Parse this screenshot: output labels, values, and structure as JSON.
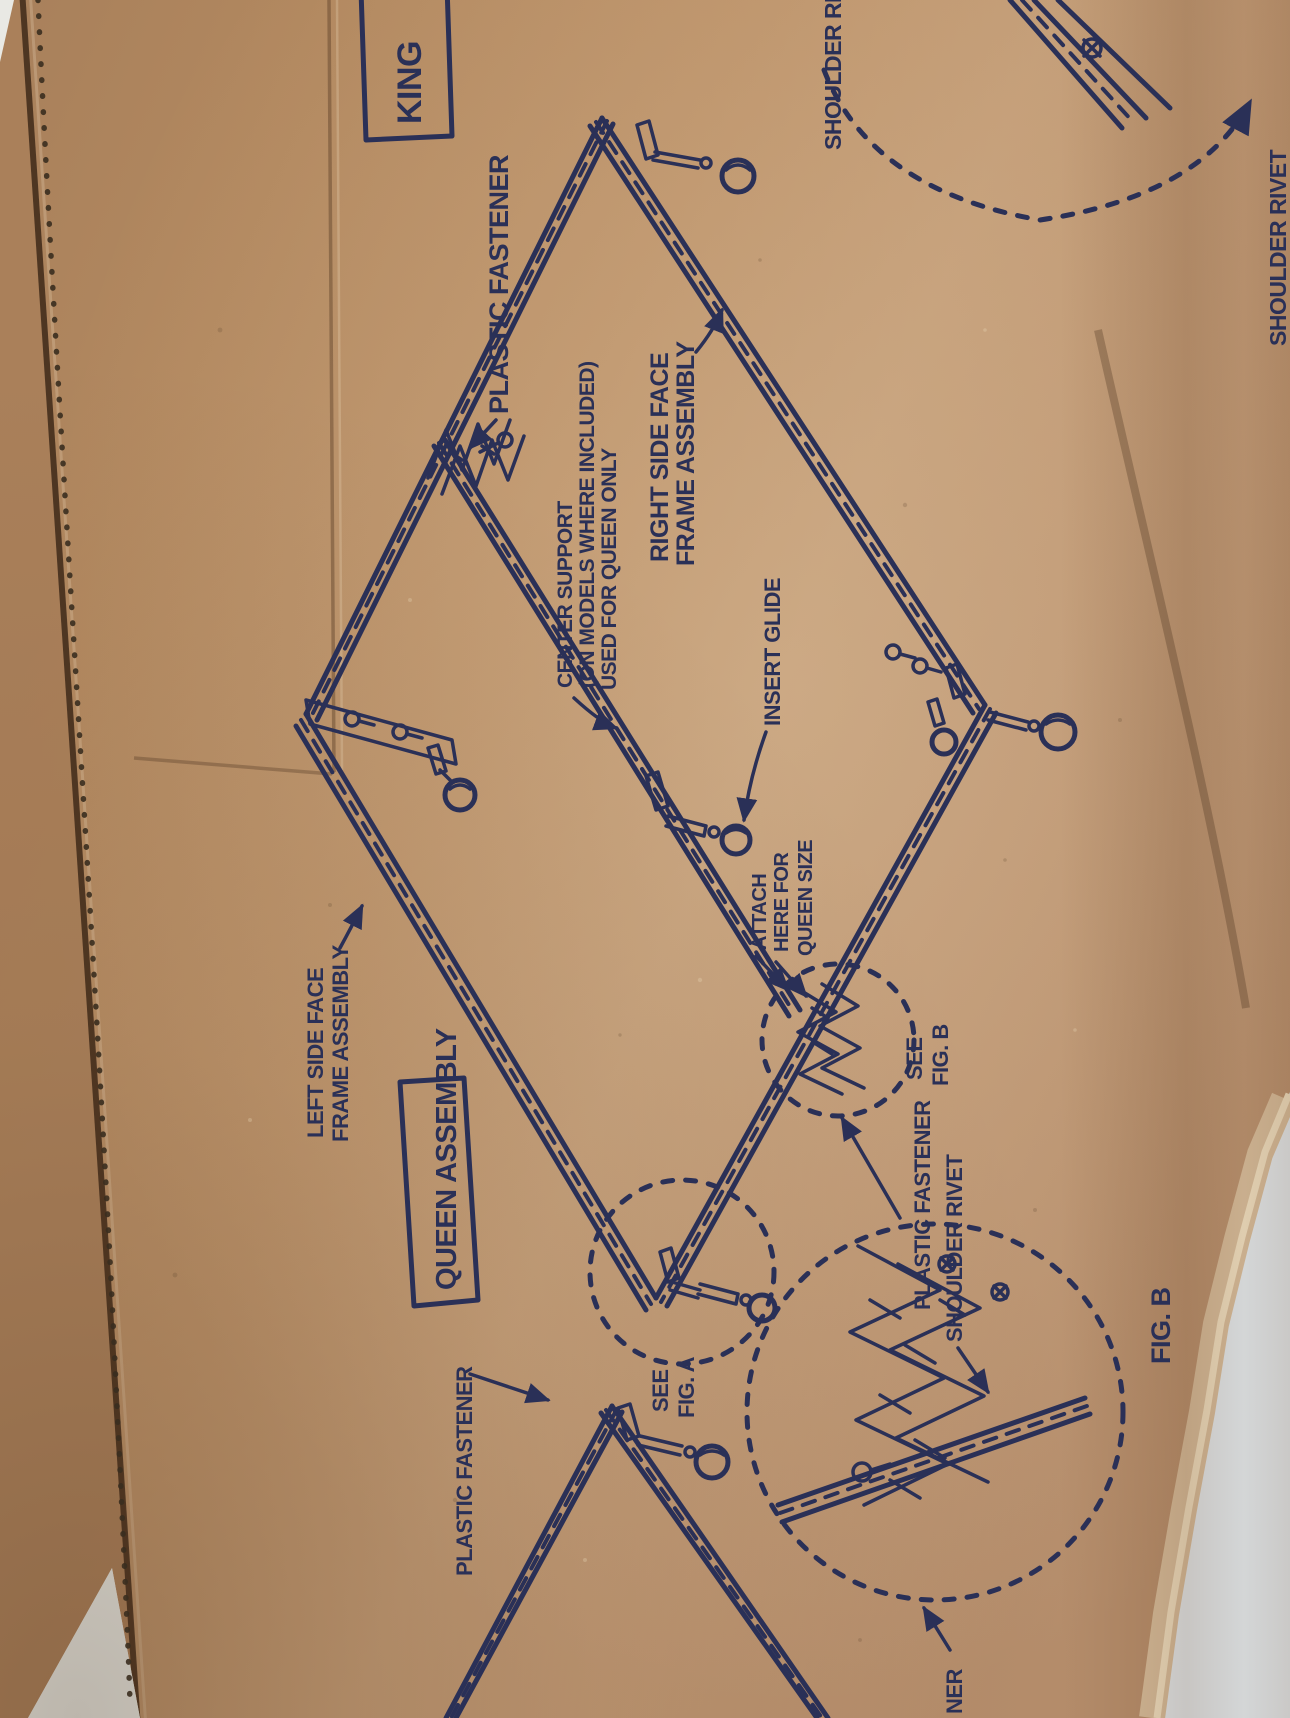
{
  "colors": {
    "cardboard": "#b8906a",
    "cardboard_shadow": "#a07a55",
    "cardboard_edge_rim": "#d6bd9c",
    "ink": "#2a3057",
    "backdrop": "#e4ecf1",
    "perforation_dots": "#3a2e1f"
  },
  "diagram": {
    "king_label": "KING",
    "queen_assembly_label": "QUEEN ASSEMBLY",
    "labels": {
      "plastic_fastener_top": "PLASTIC FASTENER",
      "center_support": {
        "lines": [
          "CENTER SUPPORT",
          "(ON MODELS WHERE INCLUDED)",
          "USED FOR QUEEN ONLY"
        ]
      },
      "right_side": {
        "lines": [
          "RIGHT SIDE FACE",
          "FRAME ASSEMBLY"
        ]
      },
      "shoulder_rivet_top": "SHOULDER RIVET",
      "shoulder_rivet_right": "SHOULDER RIVET",
      "insert_glide": "INSERT GLIDE",
      "left_side": {
        "lines": [
          "LEFT SIDE FACE",
          "FRAME ASSEMBLY"
        ]
      },
      "attach_here": {
        "lines": [
          "ATTACH",
          "HERE FOR",
          "QUEEN SIZE"
        ]
      },
      "see_fig_b": {
        "lines": [
          "SEE",
          "FIG. B"
        ]
      },
      "plastic_fastener_mid": "PLASTIC FASTENER",
      "shoulder_rivet_mid": "SHOULDER RIVET",
      "fig_b": "FIG. B",
      "see_fig_a": {
        "lines": [
          "SEE",
          "FIG. A"
        ]
      },
      "plastic_fastener_bottom_left": "PLASTIC FASTENER",
      "partial_fastener_bottom": "NER"
    }
  }
}
